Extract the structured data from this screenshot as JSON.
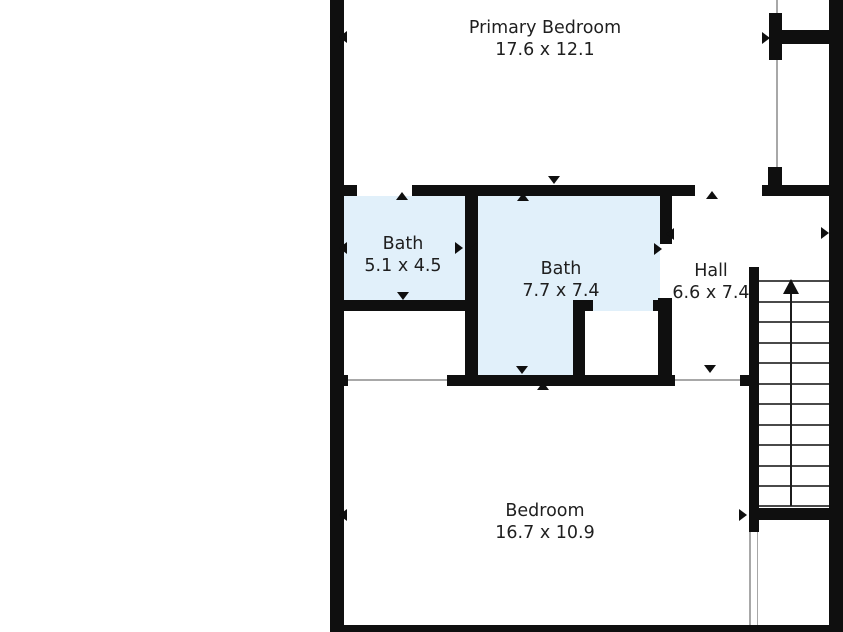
{
  "rooms": [
    {
      "name": "Primary Bedroom",
      "dims": "17.6 x 12.1"
    },
    {
      "name": "Bath",
      "dims": "5.1 x 4.5"
    },
    {
      "name": "Bath",
      "dims": "7.7 x 7.4"
    },
    {
      "name": "Hall",
      "dims": "6.6 x 7.4"
    },
    {
      "name": "Bedroom",
      "dims": "16.7 x 10.9"
    }
  ],
  "colors": {
    "wall": "#0f0f0f",
    "room_highlight": "#e1f0fa",
    "background": "#ffffff",
    "text": "#1f1f1f",
    "tread_line": "#4a4a4a",
    "opening_line": "#a8a8a8"
  },
  "plan": {
    "fills": [
      {
        "name": "bath-1-floor",
        "x": 344,
        "y": 196,
        "w": 121,
        "h": 104,
        "bg": "highlight"
      },
      {
        "name": "bath-2-floor",
        "x": 478,
        "y": 196,
        "w": 182,
        "h": 179,
        "bg": "highlight"
      },
      {
        "name": "bath-2-closet-floor",
        "x": 585,
        "y": 311,
        "w": 73,
        "h": 64,
        "bg": "background"
      }
    ],
    "thin_lines": [
      {
        "name": "closet-opening-line",
        "x": 776,
        "y": 0,
        "w": 1.5,
        "h": 185
      },
      {
        "name": "closet-bedroom-opening-line",
        "x": 348,
        "y": 379,
        "w": 99,
        "h": 1.5
      },
      {
        "name": "hall-bedroom-opening-line",
        "x": 675,
        "y": 379,
        "w": 65,
        "h": 1.5
      },
      {
        "name": "stair-landing-opening-line-left",
        "x": 749,
        "y": 532,
        "w": 1.5,
        "h": 93
      },
      {
        "name": "stair-landing-opening-line-right",
        "x": 756.5,
        "y": 532,
        "w": 1.5,
        "h": 93
      }
    ],
    "walls": [
      {
        "name": "outer-wall-left",
        "x": 330,
        "y": 0,
        "w": 14,
        "h": 632
      },
      {
        "name": "outer-wall-right",
        "x": 829,
        "y": 0,
        "w": 14,
        "h": 632
      },
      {
        "name": "outer-wall-bottom",
        "x": 330,
        "y": 625,
        "w": 513,
        "h": 7
      },
      {
        "name": "closet-wall-vertical-top",
        "x": 769,
        "y": 13,
        "w": 13,
        "h": 47
      },
      {
        "name": "closet-wall-vertical-bottom",
        "x": 768,
        "y": 167,
        "w": 14,
        "h": 29
      },
      {
        "name": "closet-wall-horizontal",
        "x": 775,
        "y": 30,
        "w": 68,
        "h": 14
      },
      {
        "name": "middle-top-wall-seg1",
        "x": 330,
        "y": 185,
        "w": 27,
        "h": 11
      },
      {
        "name": "middle-top-wall-seg2",
        "x": 412,
        "y": 185,
        "w": 283,
        "h": 11
      },
      {
        "name": "middle-top-wall-seg3",
        "x": 762,
        "y": 185,
        "w": 81,
        "h": 11
      },
      {
        "name": "bath-divider-wall",
        "x": 465,
        "y": 196,
        "w": 13,
        "h": 189
      },
      {
        "name": "bath-2-right-wall-upper",
        "x": 660,
        "y": 196,
        "w": 12,
        "h": 48
      },
      {
        "name": "bath-1-bottom-wall",
        "x": 330,
        "y": 300,
        "w": 148,
        "h": 11
      },
      {
        "name": "bath-2-closet-left-wall",
        "x": 573,
        "y": 300,
        "w": 12,
        "h": 85
      },
      {
        "name": "bath-2-closet-top-stub-left",
        "x": 573,
        "y": 300,
        "w": 20,
        "h": 11
      },
      {
        "name": "bath-2-closet-top-stub-right",
        "x": 653,
        "y": 300,
        "w": 19,
        "h": 11
      },
      {
        "name": "bath-2-closet-right-wall",
        "x": 658,
        "y": 298,
        "w": 14,
        "h": 87
      },
      {
        "name": "middle-bottom-wall-seg1",
        "x": 330,
        "y": 375,
        "w": 18,
        "h": 11
      },
      {
        "name": "middle-bottom-wall-seg2",
        "x": 447,
        "y": 375,
        "w": 228,
        "h": 11
      },
      {
        "name": "middle-bottom-wall-stub",
        "x": 740,
        "y": 375,
        "w": 19,
        "h": 11
      },
      {
        "name": "stair-left-wall",
        "x": 749,
        "y": 267,
        "w": 10,
        "h": 265
      },
      {
        "name": "stair-bottom-wall",
        "x": 749,
        "y": 508,
        "w": 94,
        "h": 12
      }
    ],
    "stairs": {
      "x1": 759,
      "x2": 829,
      "tread_ys": [
        280,
        301,
        321,
        342,
        362,
        383,
        403,
        424,
        444,
        465,
        485,
        505
      ],
      "direction_arrow": {
        "x": 791,
        "y_top": 281,
        "y_bottom": 506
      }
    },
    "door_markers": [
      {
        "name": "door-marker-primary-left-wall",
        "dir": "left",
        "x": 339,
        "y": 31
      },
      {
        "name": "door-marker-closet-entry",
        "dir": "right",
        "x": 762,
        "y": 32
      },
      {
        "name": "door-marker-bath-1-entry",
        "dir": "up",
        "x": 396,
        "y": 192
      },
      {
        "name": "door-marker-bath-2-entry-outside",
        "dir": "down",
        "x": 548,
        "y": 176
      },
      {
        "name": "door-marker-bath-2-entry-inside",
        "dir": "up",
        "x": 517,
        "y": 193
      },
      {
        "name": "door-marker-hall-top-opening",
        "dir": "up",
        "x": 706,
        "y": 191
      },
      {
        "name": "door-marker-bath-1-left-wall",
        "dir": "left",
        "x": 339,
        "y": 242
      },
      {
        "name": "door-marker-bath-divider-left",
        "dir": "right",
        "x": 455,
        "y": 242
      },
      {
        "name": "door-marker-bath-divider-right",
        "dir": "left",
        "x": 470,
        "y": 242
      },
      {
        "name": "door-marker-bath-2-hall-upper",
        "dir": "left",
        "x": 666,
        "y": 228
      },
      {
        "name": "door-marker-bath-2-hall-lower",
        "dir": "right",
        "x": 654,
        "y": 243
      },
      {
        "name": "door-marker-hall-right-wall",
        "dir": "right",
        "x": 821,
        "y": 227
      },
      {
        "name": "door-marker-bath-1-bottom",
        "dir": "down",
        "x": 397,
        "y": 292
      },
      {
        "name": "door-marker-bath-2-bottom",
        "dir": "down",
        "x": 516,
        "y": 366
      },
      {
        "name": "door-marker-bedroom-top",
        "dir": "up",
        "x": 537,
        "y": 382
      },
      {
        "name": "door-marker-hall-bottom-opening",
        "dir": "down",
        "x": 704,
        "y": 365
      },
      {
        "name": "door-marker-bedroom-left-wall",
        "dir": "left",
        "x": 339,
        "y": 509
      },
      {
        "name": "door-marker-stair-landing",
        "dir": "right",
        "x": 739,
        "y": 509
      }
    ]
  }
}
